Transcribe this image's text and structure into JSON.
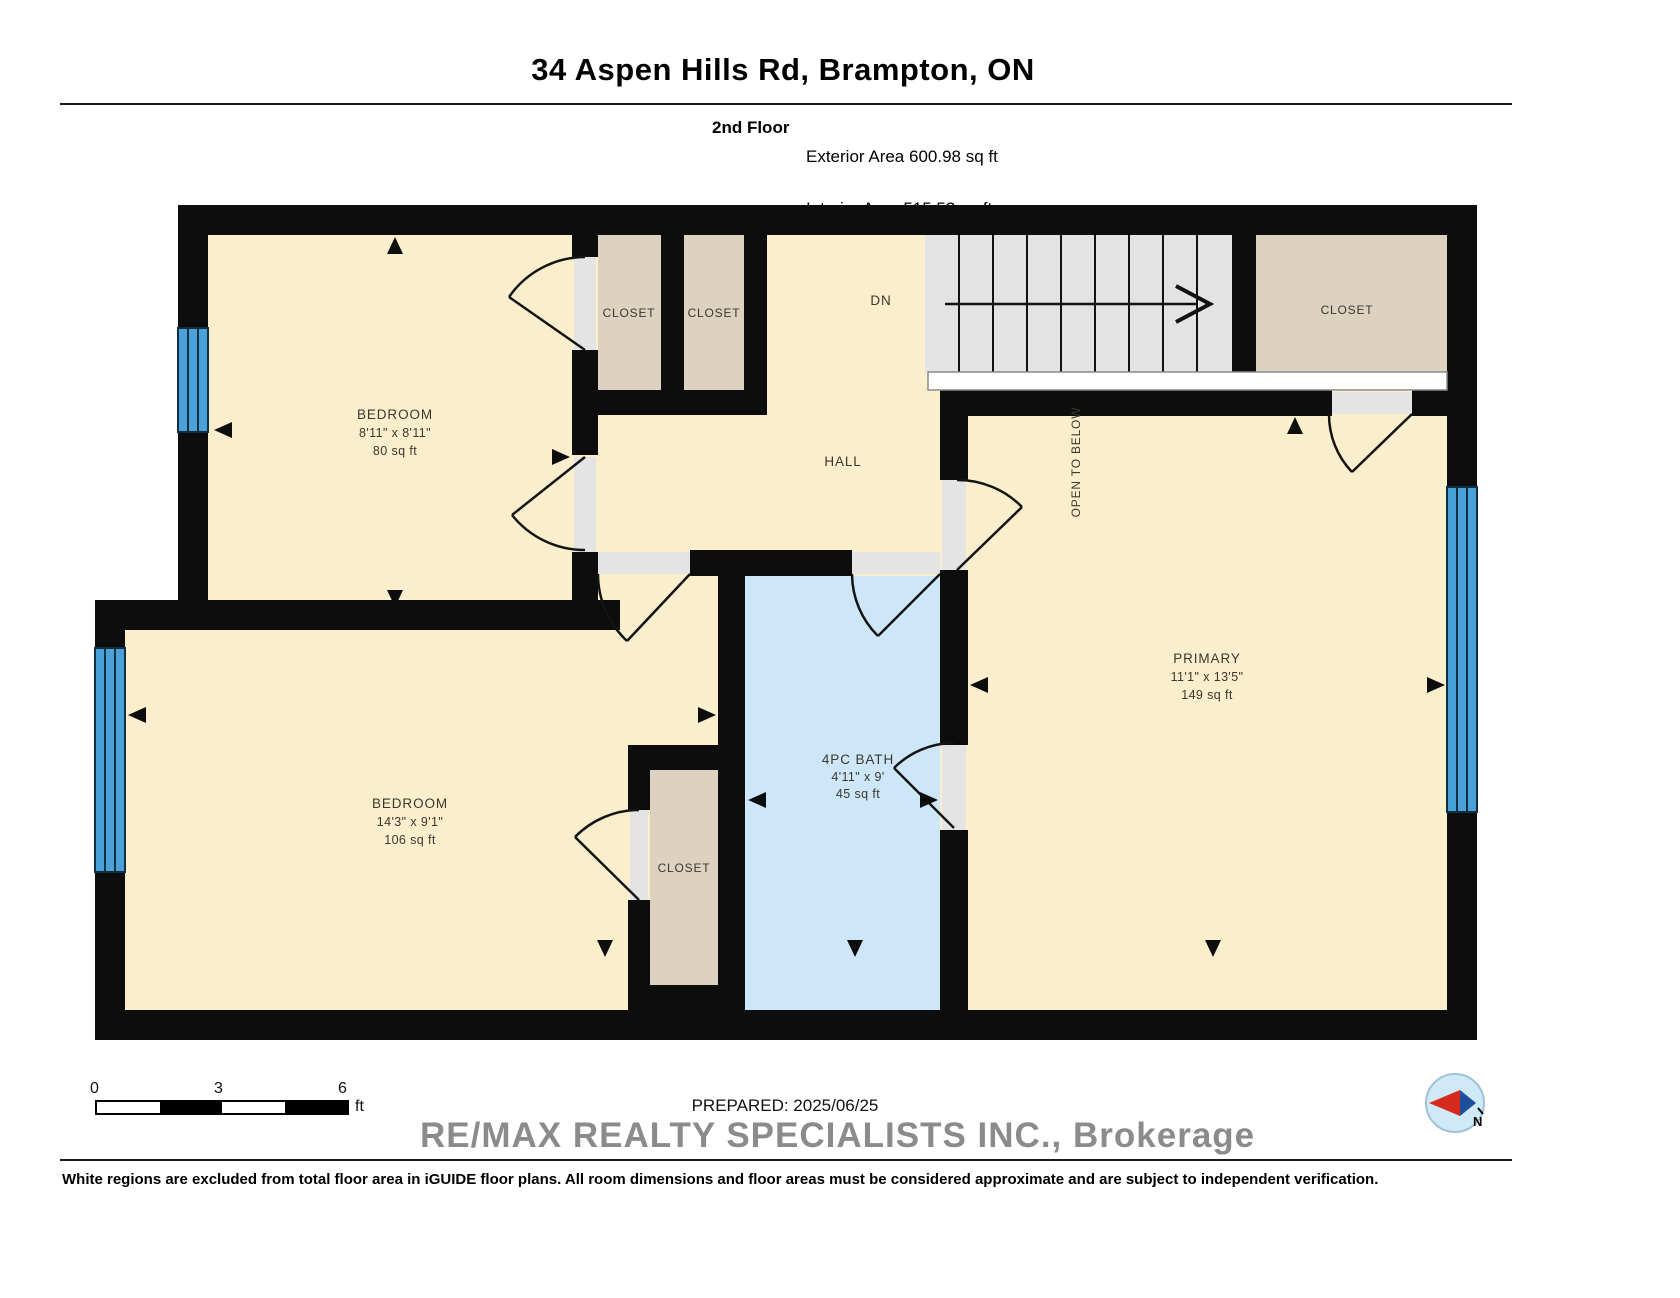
{
  "header": {
    "title": "34 Aspen Hills Rd, Brampton, ON",
    "floor_label": "2nd Floor",
    "stats": [
      "Exterior Area 600.98 sq ft",
      "Interior Area 515.53 sq ft",
      "Excluded Area 1.54 sq ft"
    ]
  },
  "plan": {
    "bedroom_top": {
      "name": "BEDROOM",
      "dims": "8'11\" x 8'11\"",
      "area": "80 sq ft"
    },
    "bedroom_bottom": {
      "name": "BEDROOM",
      "dims": "14'3\" x 9'1\"",
      "area": "106 sq ft"
    },
    "primary": {
      "name": "PRIMARY",
      "dims": "11'1\" x 13'5\"",
      "area": "149 sq ft"
    },
    "bath": {
      "name": "4PC BATH",
      "dims": "4'11\" x 9'",
      "area": "45 sq ft"
    },
    "hall": {
      "name": "HALL"
    },
    "stairs": {
      "down_label": "DN",
      "open_label": "OPEN TO BELOW"
    },
    "closets": {
      "top_left": "CLOSET",
      "top_mid": "CLOSET",
      "top_right": "CLOSET",
      "bottom": "CLOSET"
    }
  },
  "scale_bar": {
    "ticks": [
      "0",
      "3",
      "6"
    ],
    "unit": "ft"
  },
  "footer": {
    "prepared_label": "PREPARED: 2025/06/25",
    "watermark": "RE/MAX REALTY SPECIALISTS INC., Brokerage",
    "disclaimer": "White regions are excluded from total floor area in iGUIDE floor plans. All room dimensions and floor areas must be considered approximate and are subject to independent verification.",
    "compass_north_label": "N"
  },
  "colors": {
    "wall": "#0d0d0d",
    "room_cream": "#faeecd",
    "closet_taupe": "#ddd2c0",
    "bath_blue": "#cde7f8",
    "stairs_gray": "#e3e3e3",
    "window_blue": "#4aa0d8",
    "open_below_white": "#ffffff"
  }
}
